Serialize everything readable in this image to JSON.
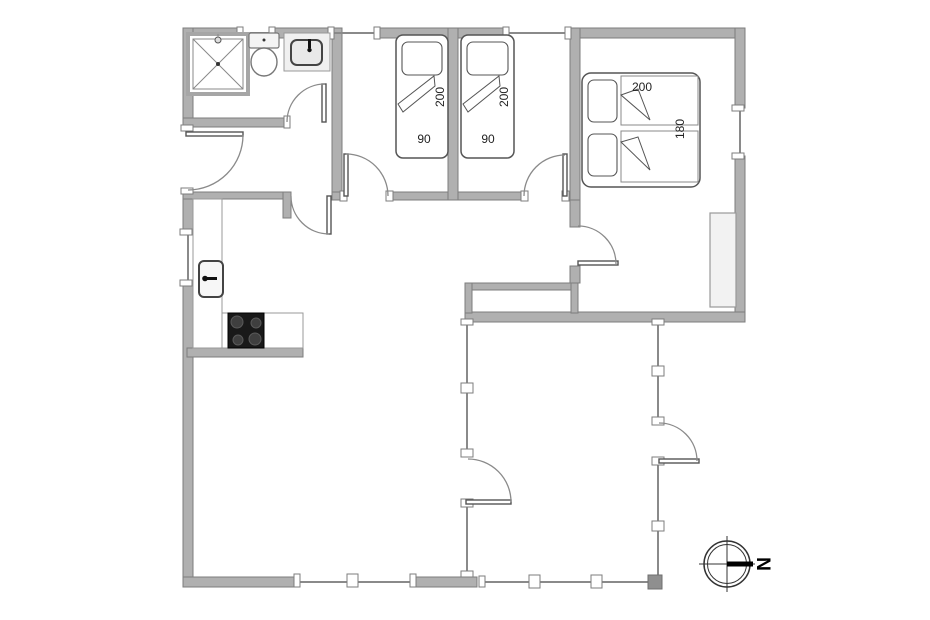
{
  "drawing": {
    "type": "floor-plan",
    "bed_labels": {
      "single_bed_1": {
        "length_cm": "200",
        "width_cm": "90"
      },
      "single_bed_2": {
        "length_cm": "200",
        "width_cm": "90"
      },
      "double_bed": {
        "length_cm": "200",
        "width_cm": "180"
      }
    },
    "compass": {
      "north_label": "N"
    },
    "colors": {
      "wall_fill": "#b0b0b0",
      "wall_stroke": "#7d7d7d",
      "glass_line": "#8a8a8a",
      "fixture_stroke": "#666666",
      "closet_fill": "#f2f2f2",
      "cooktop_fill": "#1a1a1a",
      "background": "#ffffff"
    }
  }
}
